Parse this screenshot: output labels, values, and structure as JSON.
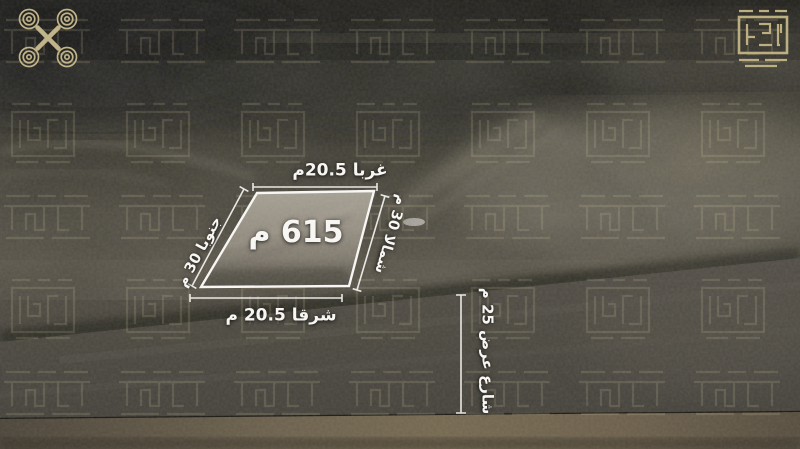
{
  "image": {
    "type": "aerial-land-plot-listing",
    "language": "ar"
  },
  "plot": {
    "area": "615 م",
    "dimensions": {
      "west": "غربا 20.5م",
      "east": "شرقا 20.5 م",
      "south": "جنوبا 30 م",
      "north": "شمالا 30 م"
    }
  },
  "street": {
    "label": "شارع عرض 25 م"
  },
  "branding": {
    "top_left_icon": "drone-spiral-logo",
    "top_right_icon": "square-kufic-logo",
    "watermark": "square-kufic-pattern",
    "accent_color": "#c9bc8e"
  },
  "palette": {
    "terrain_dark": "#1d1c18",
    "terrain_mid": "#4a463c",
    "dirt_light": "#6d675a",
    "plot_fill": "#99938a",
    "street": "#48453f",
    "bottom_strip": "#6b604c",
    "annotation_line": "#f5f4f0"
  }
}
